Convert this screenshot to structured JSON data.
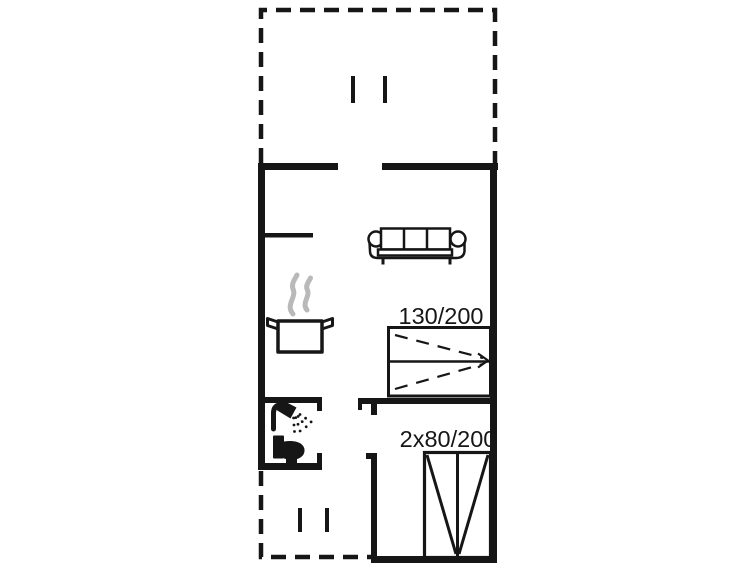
{
  "colors": {
    "background": "#ffffff",
    "line": "#161616",
    "steam": "#b9b9b9"
  },
  "floor_plan": {
    "type": "summerhouse-floor-plan",
    "beds": {
      "double_label": "130/200",
      "bunk_label": "2x80/200"
    },
    "icons": [
      "sofa-icon",
      "cooking-pot-icon",
      "steam-icon",
      "shower-icon",
      "toilet-icon",
      "double-bed-icon",
      "bunk-bed-icon",
      "window-marker-icon",
      "terrace-dashed-outline"
    ]
  }
}
